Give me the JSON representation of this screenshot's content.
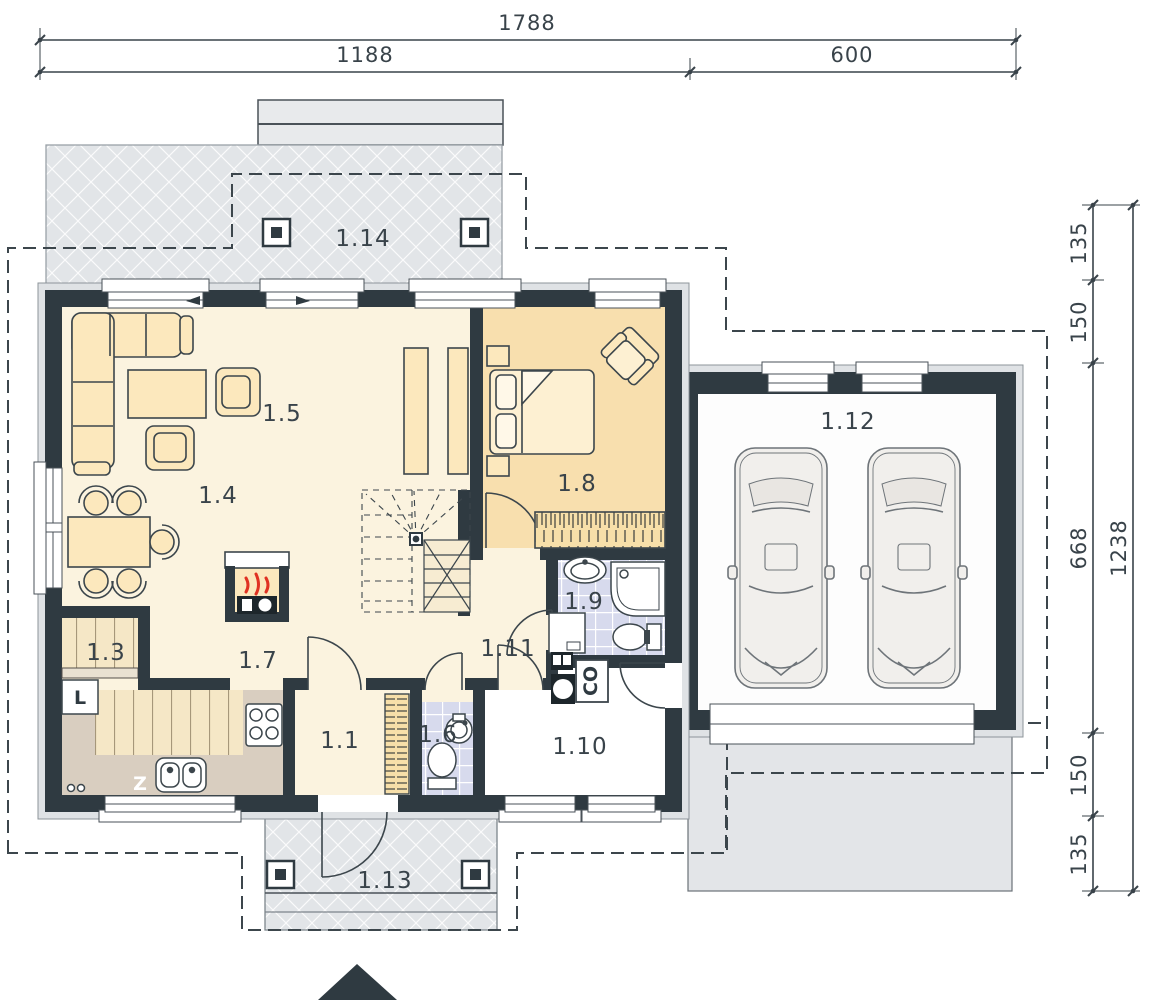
{
  "dims": {
    "w_total": "1788",
    "w_left": "1188",
    "w_right": "600",
    "h_total": "1238",
    "h_1": "135",
    "h_2": "150",
    "h_3": "668",
    "h_4": "150",
    "h_5": "135"
  },
  "rooms": [
    {
      "label": "1.14"
    },
    {
      "label": "1.5"
    },
    {
      "label": "1.4"
    },
    {
      "label": "1.8"
    },
    {
      "label": "1.12"
    },
    {
      "label": "1.3"
    },
    {
      "label": "1.7"
    },
    {
      "label": "1.11"
    },
    {
      "label": "1.9"
    },
    {
      "label": "1.1"
    },
    {
      "label": "1.6"
    },
    {
      "label": "1.10"
    },
    {
      "label": "1.13"
    }
  ],
  "appliances": {
    "fridge": "L",
    "sink": "Z",
    "boiler": "CO"
  },
  "colors": {
    "wall": "#2f3a41",
    "floor_cream": "#fbf3df",
    "floor_bedroom": "#f8dfae",
    "floor_tile": "#d7daed",
    "floor_plank": "#f5e7c6",
    "counter": "#d9cec0",
    "terrace": "#e2e5e8",
    "furniture": "#fce8bd",
    "flame": "#e03222"
  }
}
